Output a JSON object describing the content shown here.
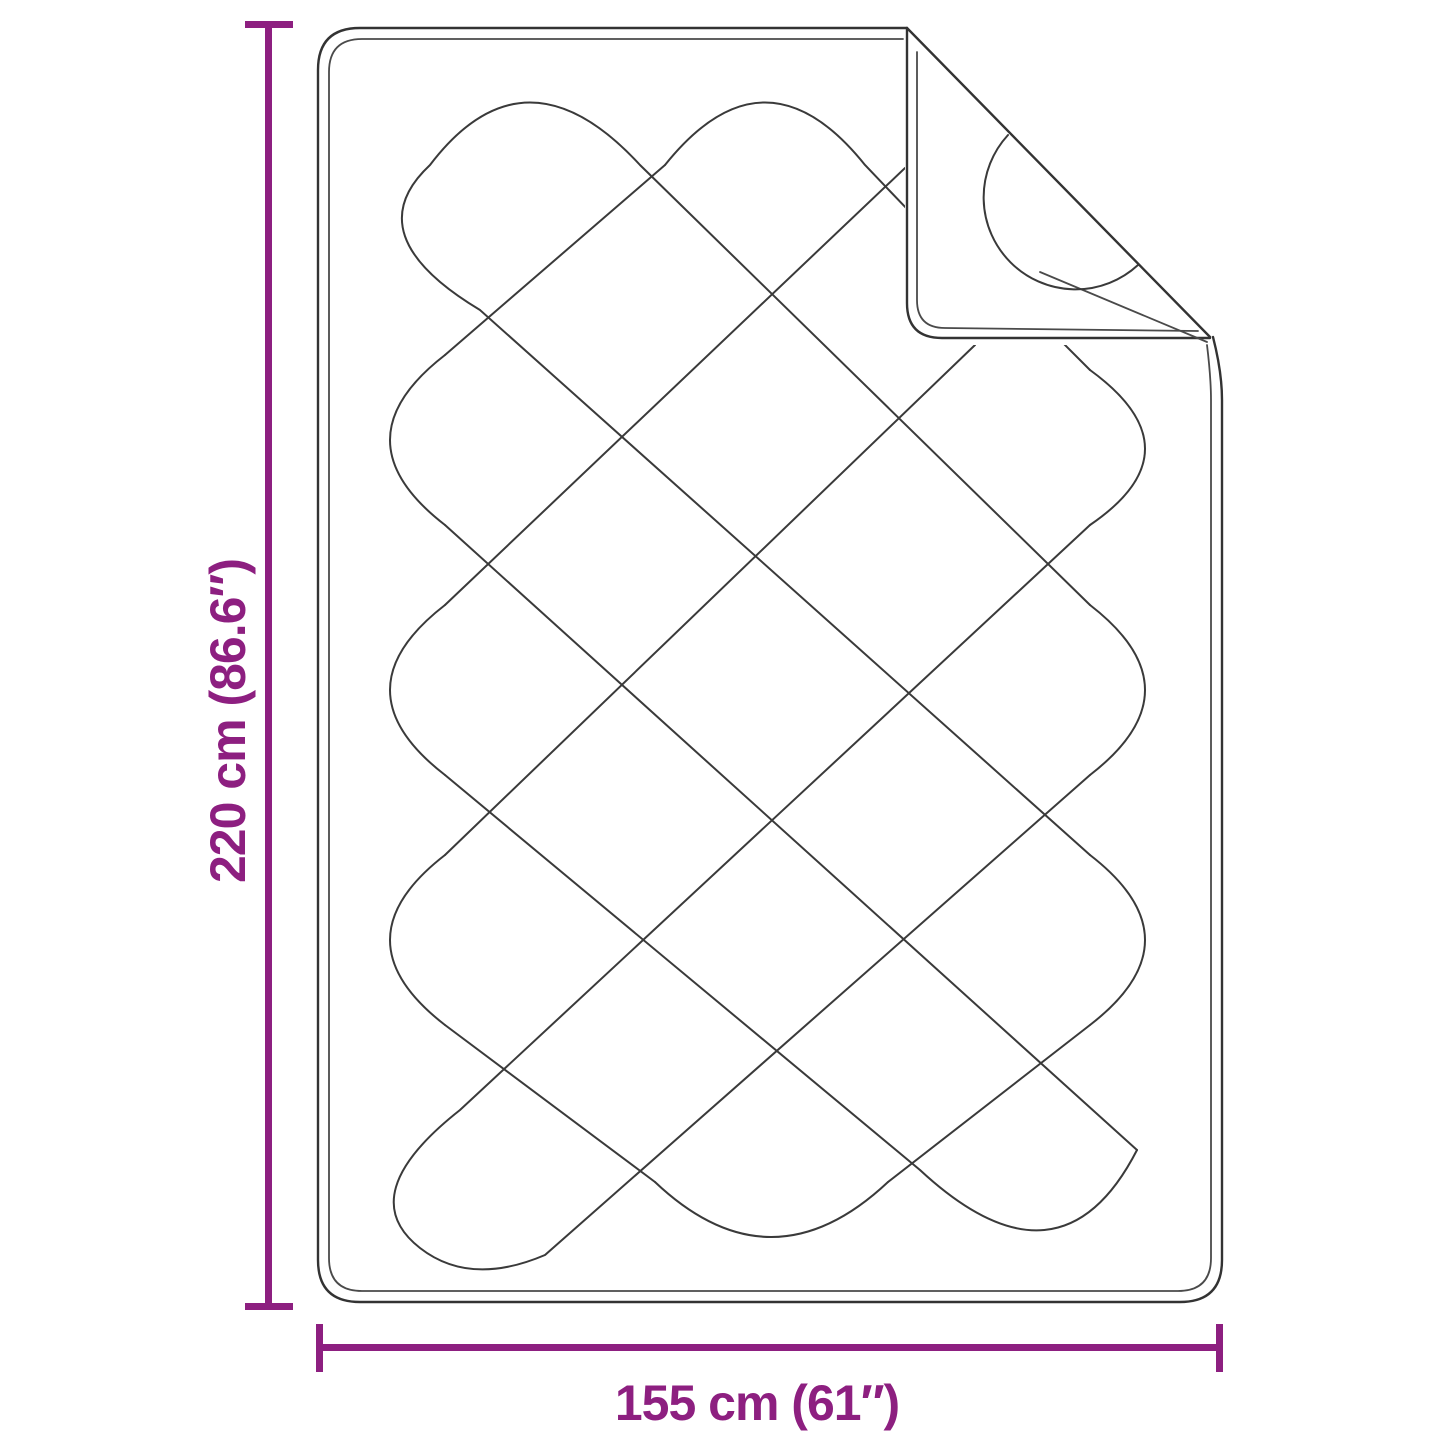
{
  "page": {
    "background": "#ffffff"
  },
  "diagram": {
    "type": "product-dimension-diagram",
    "subject": "quilted blanket with diamond stitching and folded top-right corner",
    "height_label": "220 cm (86.6″)",
    "width_label": "155 cm (61″)",
    "height_cm": 220,
    "height_in": 86.6,
    "width_cm": 155,
    "width_in": 61,
    "colors": {
      "dimension_accent": "#8D1F80",
      "line": "#3a3a3a",
      "background": "#ffffff"
    }
  }
}
